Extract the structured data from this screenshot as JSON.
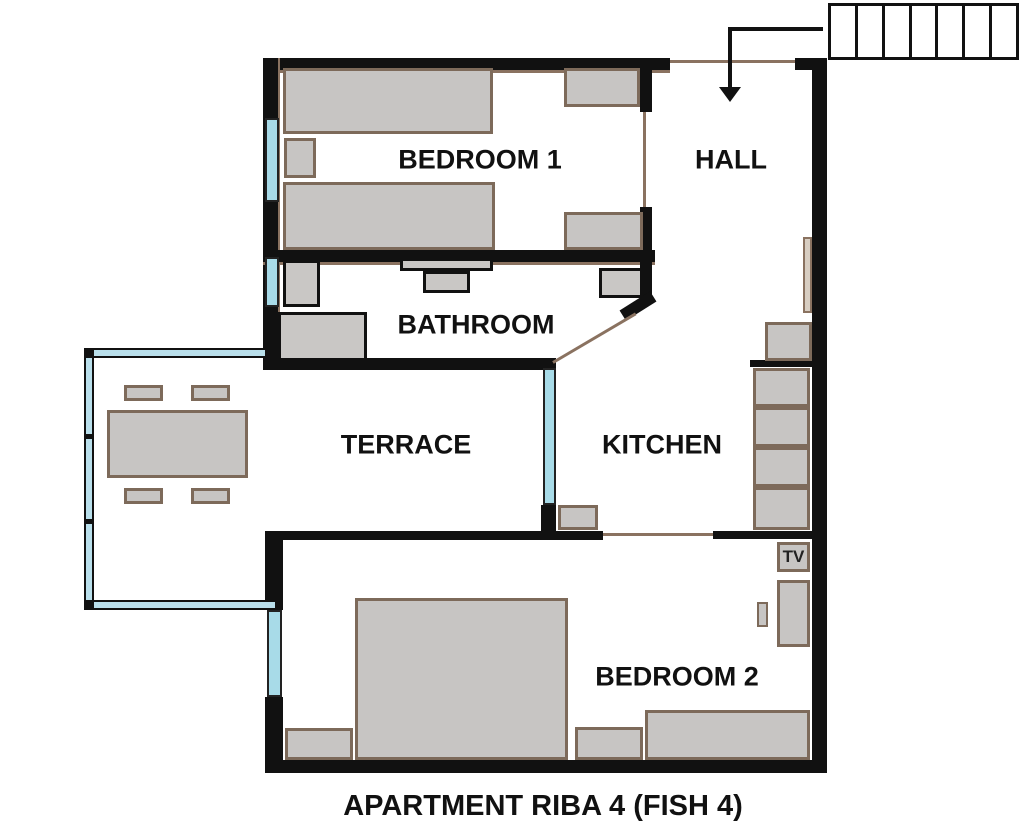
{
  "title": "APARTMENT RIBA 4 (FISH 4)",
  "rooms": [
    {
      "id": "bedroom-1",
      "label": "BEDROOM 1"
    },
    {
      "id": "hall",
      "label": "HALL"
    },
    {
      "id": "bathroom",
      "label": "BATHROOM"
    },
    {
      "id": "terrace",
      "label": "TERRACE"
    },
    {
      "id": "kitchen",
      "label": "KITCHEN"
    },
    {
      "id": "bedroom-2",
      "label": "BEDROOM 2"
    }
  ],
  "labels": {
    "tv": "TV"
  },
  "stairs": {
    "steps": 7
  },
  "icons": {
    "entry_arrow": "arrow-down-into-hall"
  },
  "colors": {
    "wall": "#111111",
    "furniture_fill": "#c7c5c3",
    "furniture_border": "#7d6a5a",
    "fixture_border": "#111111",
    "window": "#a8dbe8",
    "railing": "#b9dfeb",
    "door_line": "#8a7260",
    "door_panel": "#d8cec2"
  }
}
